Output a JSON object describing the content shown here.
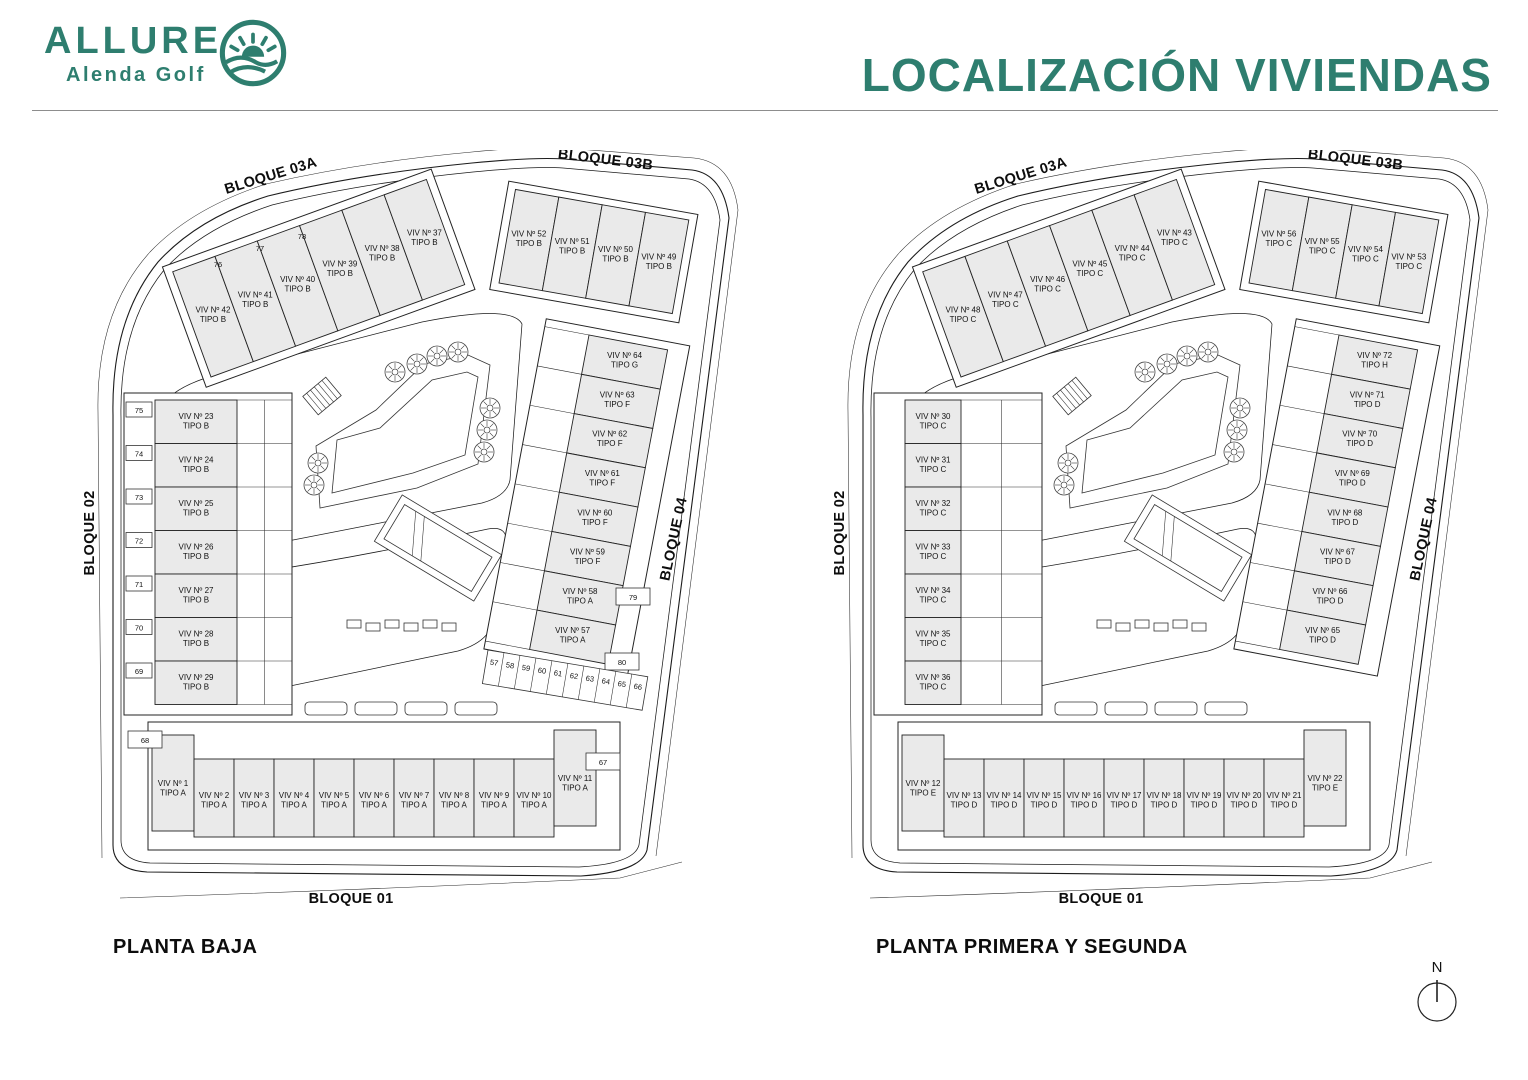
{
  "header": {
    "title": "LOCALIZACIÓN VIVIENDAS",
    "accent_color": "#2E7E6F"
  },
  "logo": {
    "brand": "ALLURE",
    "subtitle": "Alenda Golf"
  },
  "compass": {
    "label": "N"
  },
  "plans": [
    {
      "caption": "PLANTA BAJA",
      "block_labels": {
        "b01": "BLOQUE 01",
        "b02": "BLOQUE 02",
        "b03a": "BLOQUE 03A",
        "b03b": "BLOQUE 03B",
        "b04": "BLOQUE 04"
      },
      "units": {
        "b03a": [
          {
            "viv": "VIV Nº 42",
            "tipo": "TIPO B"
          },
          {
            "viv": "VIV Nº 41",
            "tipo": "TIPO B"
          },
          {
            "viv": "VIV Nº 40",
            "tipo": "TIPO B"
          },
          {
            "viv": "VIV Nº 39",
            "tipo": "TIPO B"
          },
          {
            "viv": "VIV Nº 38",
            "tipo": "TIPO B"
          },
          {
            "viv": "VIV Nº 37",
            "tipo": "TIPO B"
          }
        ],
        "b03b": [
          {
            "viv": "VIV Nº 52",
            "tipo": "TIPO B"
          },
          {
            "viv": "VIV Nº 51",
            "tipo": "TIPO B"
          },
          {
            "viv": "VIV Nº 50",
            "tipo": "TIPO B"
          },
          {
            "viv": "VIV Nº 49",
            "tipo": "TIPO B"
          }
        ],
        "b02": [
          {
            "viv": "VIV Nº 23",
            "tipo": "TIPO B"
          },
          {
            "viv": "VIV Nº 24",
            "tipo": "TIPO B"
          },
          {
            "viv": "VIV Nº 25",
            "tipo": "TIPO B"
          },
          {
            "viv": "VIV Nº 26",
            "tipo": "TIPO B"
          },
          {
            "viv": "VIV Nº 27",
            "tipo": "TIPO B"
          },
          {
            "viv": "VIV Nº 28",
            "tipo": "TIPO B"
          },
          {
            "viv": "VIV Nº 29",
            "tipo": "TIPO B"
          }
        ],
        "b04": [
          {
            "viv": "VIV Nº 64",
            "tipo": "TIPO G"
          },
          {
            "viv": "VIV Nº 63",
            "tipo": "TIPO F"
          },
          {
            "viv": "VIV Nº 62",
            "tipo": "TIPO F"
          },
          {
            "viv": "VIV Nº 61",
            "tipo": "TIPO F"
          },
          {
            "viv": "VIV Nº 60",
            "tipo": "TIPO F"
          },
          {
            "viv": "VIV Nº 59",
            "tipo": "TIPO F"
          },
          {
            "viv": "VIV Nº 58",
            "tipo": "TIPO A"
          },
          {
            "viv": "VIV Nº 57",
            "tipo": "TIPO A"
          }
        ],
        "b01": [
          {
            "viv": "VIV Nº 1",
            "tipo": "TIPO A"
          },
          {
            "viv": "VIV Nº 2",
            "tipo": "TIPO A"
          },
          {
            "viv": "VIV Nº 3",
            "tipo": "TIPO A"
          },
          {
            "viv": "VIV Nº 4",
            "tipo": "TIPO A"
          },
          {
            "viv": "VIV Nº 5",
            "tipo": "TIPO A"
          },
          {
            "viv": "VIV Nº 6",
            "tipo": "TIPO A"
          },
          {
            "viv": "VIV Nº 7",
            "tipo": "TIPO A"
          },
          {
            "viv": "VIV Nº 8",
            "tipo": "TIPO A"
          },
          {
            "viv": "VIV Nº 9",
            "tipo": "TIPO A"
          },
          {
            "viv": "VIV Nº 10",
            "tipo": "TIPO A"
          },
          {
            "viv": "VIV Nº 11",
            "tipo": "TIPO A"
          }
        ]
      },
      "parking": {
        "b03a": [
          "76",
          "77",
          "78"
        ],
        "b02": [
          "75",
          "74",
          "73",
          "72",
          "71",
          "70",
          "69"
        ],
        "b04_side": [
          "79",
          "80"
        ],
        "strip": [
          "57",
          "58",
          "59",
          "60",
          "61",
          "62",
          "63",
          "64",
          "65",
          "66"
        ],
        "corner_left": "68",
        "corner_right": "67"
      }
    },
    {
      "caption": "PLANTA PRIMERA Y SEGUNDA",
      "block_labels": {
        "b01": "BLOQUE 01",
        "b02": "BLOQUE 02",
        "b03a": "BLOQUE 03A",
        "b03b": "BLOQUE 03B",
        "b04": "BLOQUE 04"
      },
      "units": {
        "b03a": [
          {
            "viv": "VIV Nº 48",
            "tipo": "TIPO C"
          },
          {
            "viv": "VIV Nº 47",
            "tipo": "TIPO C"
          },
          {
            "viv": "VIV Nº 46",
            "tipo": "TIPO C"
          },
          {
            "viv": "VIV Nº 45",
            "tipo": "TIPO C"
          },
          {
            "viv": "VIV Nº 44",
            "tipo": "TIPO C"
          },
          {
            "viv": "VIV Nº 43",
            "tipo": "TIPO C"
          }
        ],
        "b03b": [
          {
            "viv": "VIV Nº 56",
            "tipo": "TIPO C"
          },
          {
            "viv": "VIV Nº 55",
            "tipo": "TIPO C"
          },
          {
            "viv": "VIV Nº 54",
            "tipo": "TIPO C"
          },
          {
            "viv": "VIV Nº 53",
            "tipo": "TIPO C"
          }
        ],
        "b02": [
          {
            "viv": "VIV Nº 30",
            "tipo": "TIPO C"
          },
          {
            "viv": "VIV Nº 31",
            "tipo": "TIPO C"
          },
          {
            "viv": "VIV Nº 32",
            "tipo": "TIPO C"
          },
          {
            "viv": "VIV Nº 33",
            "tipo": "TIPO C"
          },
          {
            "viv": "VIV Nº 34",
            "tipo": "TIPO C"
          },
          {
            "viv": "VIV Nº 35",
            "tipo": "TIPO C"
          },
          {
            "viv": "VIV Nº 36",
            "tipo": "TIPO C"
          }
        ],
        "b04": [
          {
            "viv": "VIV Nº 72",
            "tipo": "TIPO H"
          },
          {
            "viv": "VIV Nº 71",
            "tipo": "TIPO D"
          },
          {
            "viv": "VIV Nº 70",
            "tipo": "TIPO D"
          },
          {
            "viv": "VIV Nº 69",
            "tipo": "TIPO D"
          },
          {
            "viv": "VIV Nº 68",
            "tipo": "TIPO D"
          },
          {
            "viv": "VIV Nº 67",
            "tipo": "TIPO D"
          },
          {
            "viv": "VIV Nº 66",
            "tipo": "TIPO D"
          },
          {
            "viv": "VIV Nº 65",
            "tipo": "TIPO D"
          }
        ],
        "b01": [
          {
            "viv": "VIV Nº 12",
            "tipo": "TIPO E"
          },
          {
            "viv": "VIV Nº 13",
            "tipo": "TIPO D"
          },
          {
            "viv": "VIV Nº 14",
            "tipo": "TIPO D"
          },
          {
            "viv": "VIV Nº 15",
            "tipo": "TIPO D"
          },
          {
            "viv": "VIV Nº 16",
            "tipo": "TIPO D"
          },
          {
            "viv": "VIV Nº 17",
            "tipo": "TIPO D"
          },
          {
            "viv": "VIV Nº 18",
            "tipo": "TIPO D"
          },
          {
            "viv": "VIV Nº 19",
            "tipo": "TIPO D"
          },
          {
            "viv": "VIV Nº 20",
            "tipo": "TIPO D"
          },
          {
            "viv": "VIV Nº 21",
            "tipo": "TIPO D"
          },
          {
            "viv": "VIV Nº 22",
            "tipo": "TIPO E"
          }
        ]
      },
      "parking": null
    }
  ]
}
